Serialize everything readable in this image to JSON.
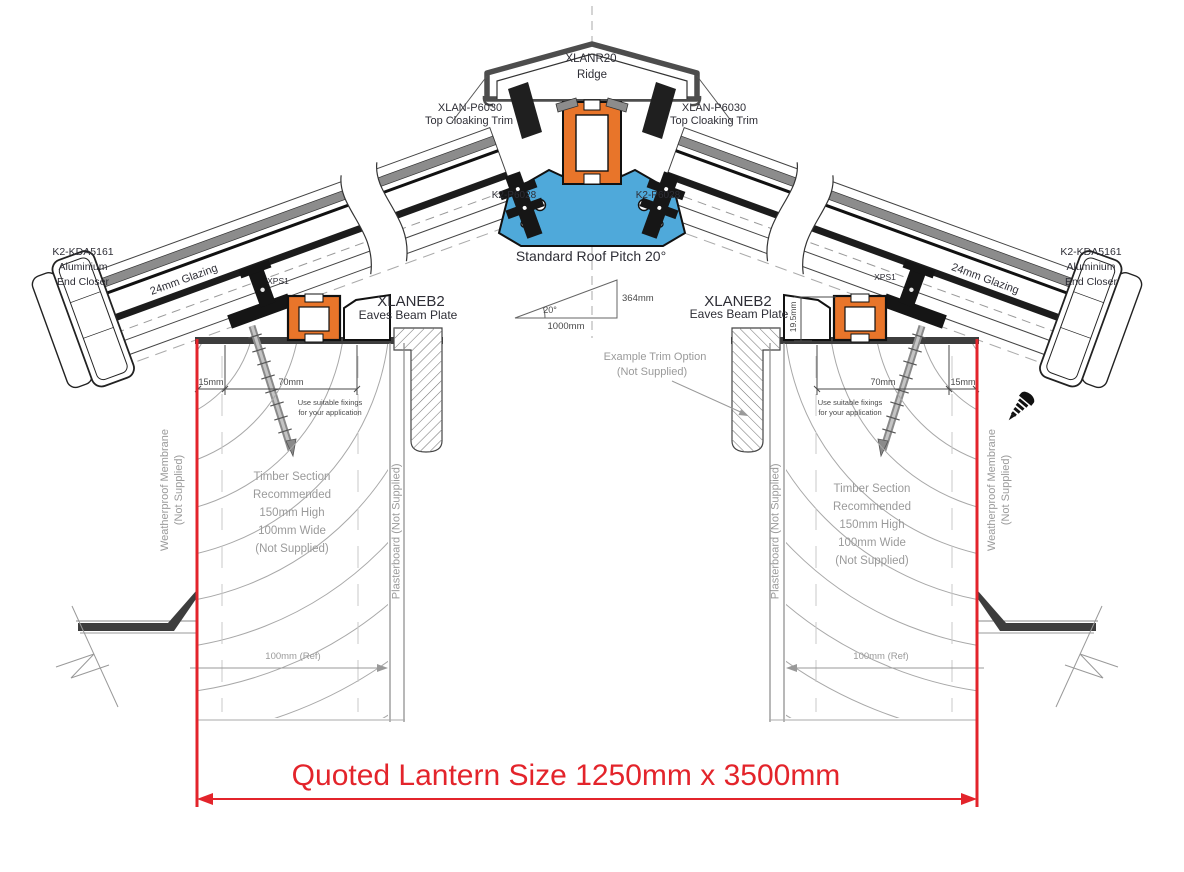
{
  "drawing_title": "Roof lantern cross section",
  "labels": {
    "ridge": {
      "code": "XLANR20",
      "name": "Ridge"
    },
    "top_cloaking_trim_left": {
      "code": "XLAN-P6030",
      "name": "Top Cloaking Trim"
    },
    "top_cloaking_trim_right": {
      "code": "XLAN-P6030",
      "name": "Top Cloaking Trim"
    },
    "ridge_fixing_left": "K2-P6028",
    "ridge_fixing_right": "K2-P6028",
    "pitch_note": "Standard Roof Pitch 20°",
    "pitch_triangle": {
      "angle": "20°",
      "base": "1000mm",
      "rise": "364mm"
    },
    "end_closer_left": {
      "code": "K2-KDA5161",
      "material": "Aluminium",
      "name": "End Closer"
    },
    "end_closer_right": {
      "code": "K2-KDA5161",
      "material": "Aluminium",
      "name": "End Closer"
    },
    "glazing_left": "24mm Glazing",
    "glazing_right": "24mm Glazing",
    "xps_left": "XPS1",
    "xps_right": "XPS1",
    "eaves_beam_left": {
      "code": "XLANEB2",
      "name": "Eaves Beam Plate"
    },
    "eaves_beam_right": {
      "code": "XLANEB2",
      "name": "Eaves Beam Plate"
    },
    "beam_height_dim": "19.5mm",
    "dims_left": {
      "edge": "15mm",
      "width": "70mm"
    },
    "dims_right": {
      "edge": "15mm",
      "width": "70mm"
    },
    "fixing_note_left": {
      "line1": "Use suitable fixings",
      "line2": "for your application"
    },
    "fixing_note_right": {
      "line1": "Use suitable fixings",
      "line2": "for your application"
    },
    "trim_option_note": {
      "line1": "Example  Trim Option",
      "line2": "(Not Supplied)"
    },
    "timber_note_left": {
      "line1": "Timber Section",
      "line2": "Recommended",
      "line3": "150mm High",
      "line4": "100mm Wide",
      "line5": "(Not Supplied)"
    },
    "timber_note_right": {
      "line1": "Timber Section",
      "line2": "Recommended",
      "line3": "150mm High",
      "line4": "100mm Wide",
      "line5": "(Not Supplied)"
    },
    "membrane_left": {
      "line1": "Weatherproof Membrane",
      "line2": "(Not Supplied)"
    },
    "membrane_right": {
      "line1": "Weatherproof Membrane",
      "line2": "(Not Supplied)"
    },
    "plasterboard_left": "Plasterboard (Not Supplied)",
    "plasterboard_right": "Plasterboard (Not Supplied)",
    "ref_dim_left": "100mm (Ref)",
    "ref_dim_right": "100mm (Ref)",
    "quoted_size": "Quoted Lantern Size 1250mm x 3500mm"
  },
  "colors": {
    "accent_red": "#e3242b",
    "thermal_break_orange": "#e8752a",
    "ridge_profile_blue": "#4fa9da",
    "note_gray": "#9a9a9a",
    "membrane_dark": "#3d3d3d"
  }
}
